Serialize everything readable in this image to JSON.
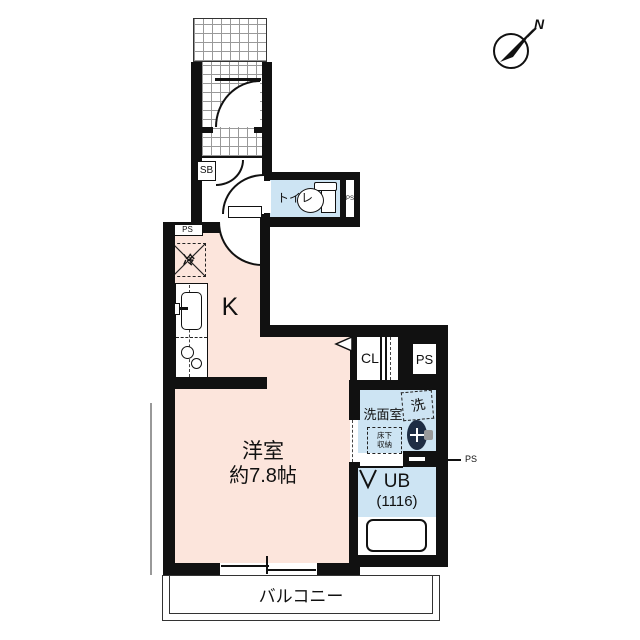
{
  "meta": {
    "drawing_type": "apartment-floor-plan"
  },
  "compass": {
    "north_label": "N"
  },
  "rooms": {
    "entrance": {
      "shoe_box_label": "SB"
    },
    "toilet": {
      "label": "トイレ",
      "ps_label": "PS"
    },
    "kitchen": {
      "label": "K",
      "fridge_label": "冷",
      "ps_label": "PS"
    },
    "closet": {
      "label": "CL"
    },
    "pipe_space": {
      "label": "PS"
    },
    "washroom": {
      "label": "洗面室",
      "washer_label": "洗",
      "floor_storage_line1": "床下",
      "floor_storage_line2": "収納",
      "ps_callout": "PS"
    },
    "bath": {
      "label": "UB",
      "size": "(1116)"
    },
    "main_room": {
      "label": "洋室",
      "size": "約7.8帖"
    },
    "balcony": {
      "label": "バルコニー"
    }
  },
  "colors": {
    "floor_pink": "#fce5dc",
    "wet_area_blue": "#cde4f3",
    "wall_black": "#111111"
  }
}
